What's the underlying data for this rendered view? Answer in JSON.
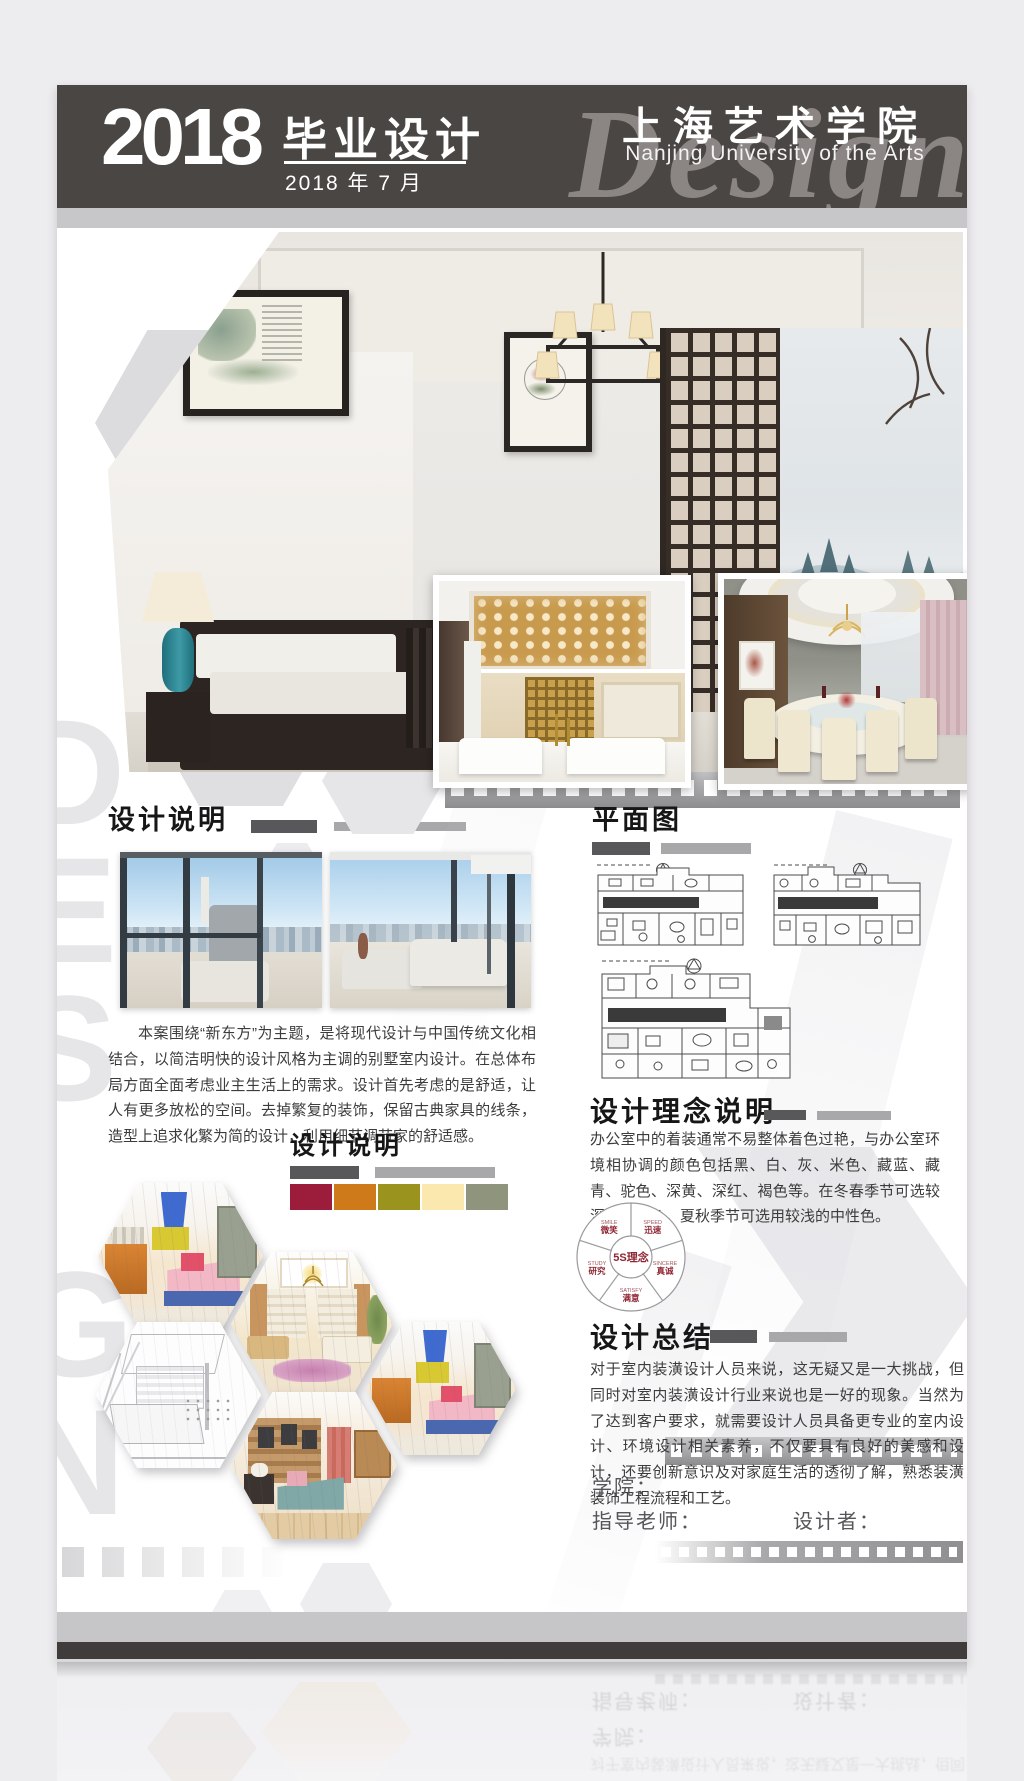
{
  "header": {
    "year": "2018",
    "title": "毕业设计",
    "date": "2018 年 7 月",
    "school_cn": "上海艺术学院",
    "school_en": "Nanjing University of the Arts",
    "watermark": "Design"
  },
  "side_watermark": "DESIGN",
  "sections": {
    "desc1": {
      "title": "设计说明",
      "paragraph": "本案围绕“新东方”为主题，是将现代设计与中国传统文化相结合，以简洁明快的设计风格为主调的别墅室内设计。在总体布局方面全面考虑业主生活上的需求。设计首先考虑的是舒适，让人有更多放松的空间。去掉繁复的装饰，保留古典家具的线条，造型上追求化繁为简的设计，利用细节调节家的舒适感。"
    },
    "plan": {
      "title": "平面图"
    },
    "desc2": {
      "title": "设计说明"
    },
    "concept": {
      "title": "设计理念说明",
      "paragraph": "办公室中的着装通常不易整体着色过艳，与办公室环境相协调的颜色包括黑、白、灰、米色、藏蓝、藏青、驼色、深黄、深红、褐色等。在冬春季节可选较深的中性色，夏秋季节可选用较浅的中性色。"
    },
    "five_s": {
      "center": "5S理念",
      "items": [
        {
          "en": "SMILE",
          "zh": "微笑"
        },
        {
          "en": "SPEED",
          "zh": "迅速"
        },
        {
          "en": "SINCERE",
          "zh": "真诚"
        },
        {
          "en": "SATISFY",
          "zh": "满意"
        },
        {
          "en": "STUDY",
          "zh": "研究"
        }
      ]
    },
    "summary": {
      "title": "设计总结",
      "paragraph": "对于室内装潢设计人员来说，这无疑又是一大挑战，但同时对室内装潢设计行业来说也是一好的现象。当然为了达到客户要求，就需要设计人员具备更专业的室内设计、环境设计相关素养，不仅要具有良好的美感和设计，还要创新意识及对家庭生活的透彻了解，熟悉装潢装饰工程流程和工艺。"
    }
  },
  "palette": {
    "swatches": [
      "#9c1c3c",
      "#ce7a1b",
      "#9a941f",
      "#fbe8af",
      "#8f947d"
    ]
  },
  "footer": {
    "school_label": "学院：",
    "advisor_label": "指导老师：",
    "designer_label": "设计者："
  },
  "colors": {
    "header_band": "#4a4644",
    "accent_red": "#8e2532",
    "bar_dark": "#58585a",
    "bar_light": "#a8a8aa"
  }
}
